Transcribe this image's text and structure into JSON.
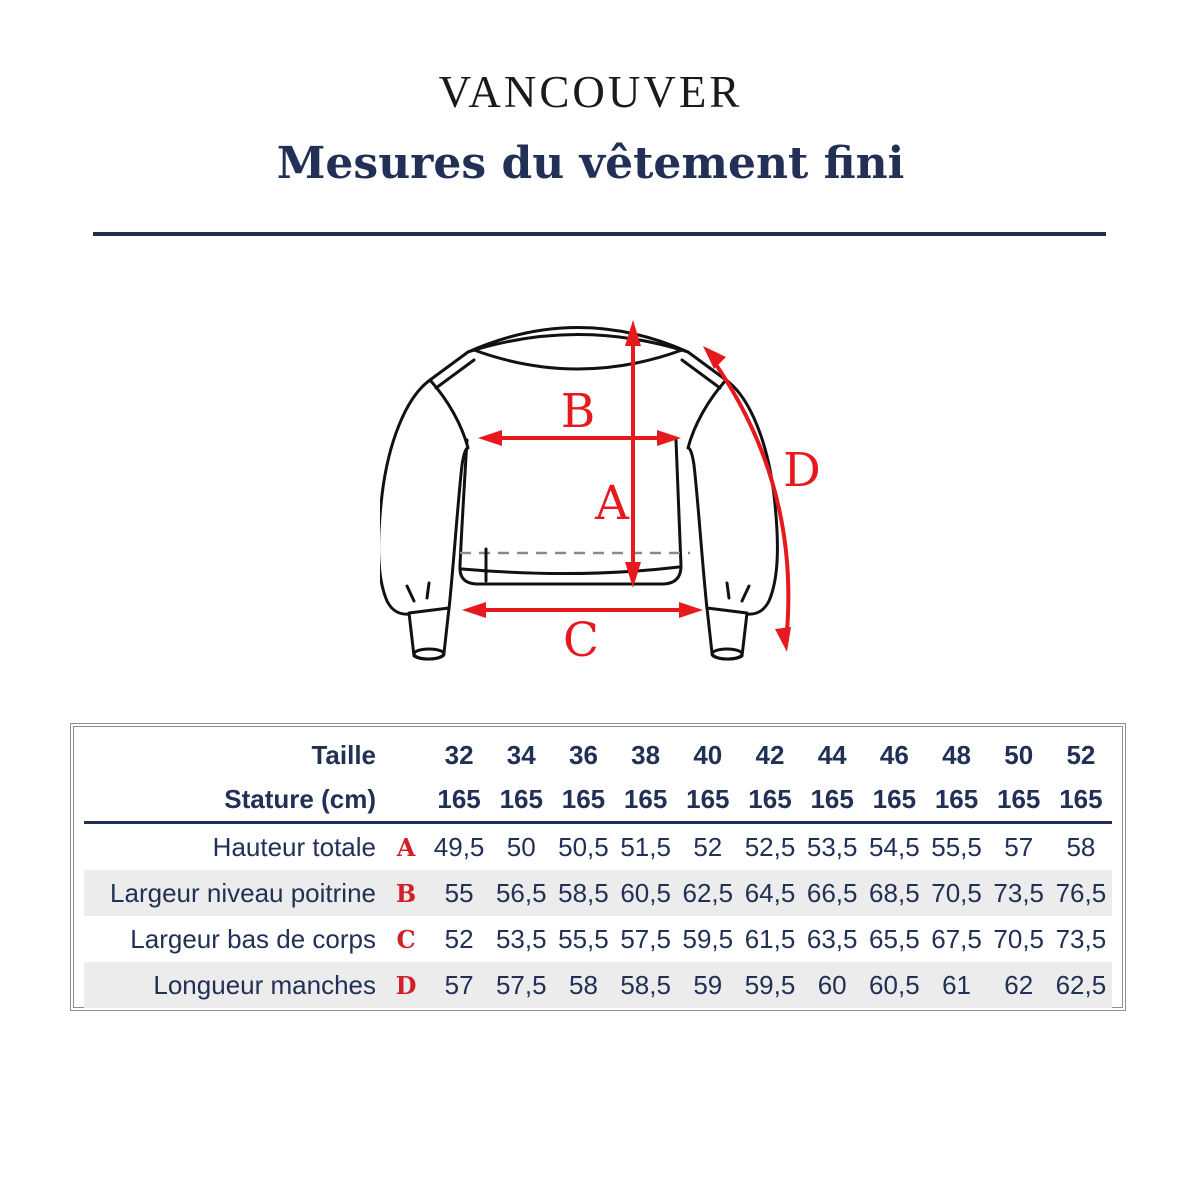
{
  "title": "VANCOUVER",
  "subtitle": "Mesures du vêtement fini",
  "diagram": {
    "garment": "sweatshirt-front-sketch",
    "labels": {
      "a": "A",
      "b": "B",
      "c": "C",
      "d": "D"
    }
  },
  "table": {
    "header_rows": [
      {
        "label": "Taille",
        "values": [
          "32",
          "34",
          "36",
          "38",
          "40",
          "42",
          "44",
          "46",
          "48",
          "50",
          "52"
        ]
      },
      {
        "label": "Stature (cm)",
        "values": [
          "165",
          "165",
          "165",
          "165",
          "165",
          "165",
          "165",
          "165",
          "165",
          "165",
          "165"
        ]
      }
    ],
    "rows": [
      {
        "label": "Hauteur totale",
        "letter": "A",
        "values": [
          "49,5",
          "50",
          "50,5",
          "51,5",
          "52",
          "52,5",
          "53,5",
          "54,5",
          "55,5",
          "57",
          "58"
        ]
      },
      {
        "label": "Largeur niveau poitrine",
        "letter": "B",
        "values": [
          "55",
          "56,5",
          "58,5",
          "60,5",
          "62,5",
          "64,5",
          "66,5",
          "68,5",
          "70,5",
          "73,5",
          "76,5"
        ]
      },
      {
        "label": "Largeur bas de corps",
        "letter": "C",
        "values": [
          "52",
          "53,5",
          "55,5",
          "57,5",
          "59,5",
          "61,5",
          "63,5",
          "65,5",
          "67,5",
          "70,5",
          "73,5"
        ]
      },
      {
        "label": "Longueur manches",
        "letter": "D",
        "values": [
          "57",
          "57,5",
          "58",
          "58,5",
          "59",
          "59,5",
          "60",
          "60,5",
          "61",
          "62",
          "62,5"
        ]
      }
    ]
  },
  "colors": {
    "navy": "#223056",
    "title_black": "#191920",
    "red_diagram": "#e6191f",
    "red_table": "#d22028",
    "stripe": "#ececec",
    "table_border": "#8f8f8f",
    "rule_navy": "#242e4e"
  }
}
